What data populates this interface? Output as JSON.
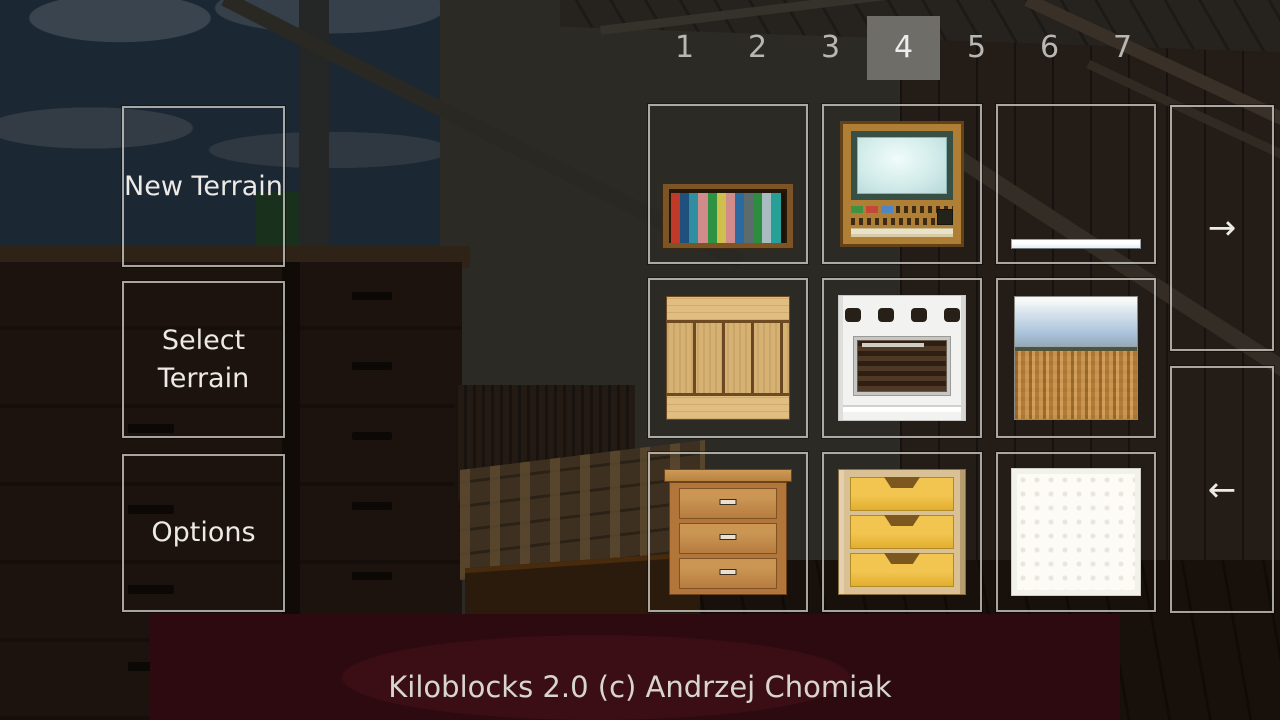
{
  "footer": {
    "credit": "Kiloblocks 2.0 (c) Andrzej Chomiak"
  },
  "menu": {
    "buttons": [
      {
        "label": "New Terrain"
      },
      {
        "label": "Select Terrain"
      },
      {
        "label": "Options"
      }
    ]
  },
  "hotbar": {
    "pages": [
      "1",
      "2",
      "3",
      "4",
      "5",
      "6",
      "7"
    ],
    "selected_page": "4"
  },
  "palette": {
    "tiles": [
      {
        "name": "bookshelf"
      },
      {
        "name": "television"
      },
      {
        "name": "white-slab"
      },
      {
        "name": "wooden-planks"
      },
      {
        "name": "stove"
      },
      {
        "name": "terrain-view"
      },
      {
        "name": "wooden-dresser"
      },
      {
        "name": "yellow-drawers"
      },
      {
        "name": "white-block"
      }
    ]
  },
  "pager": {
    "next_label": "→",
    "prev_label": "←"
  },
  "colors": {
    "panel_border": "#a9a8a2",
    "selected_page_bg": "#6f6d67",
    "button_text": "#eceae6",
    "page_number": "#b8b7b3",
    "footer_text": "#d8d5d1"
  }
}
